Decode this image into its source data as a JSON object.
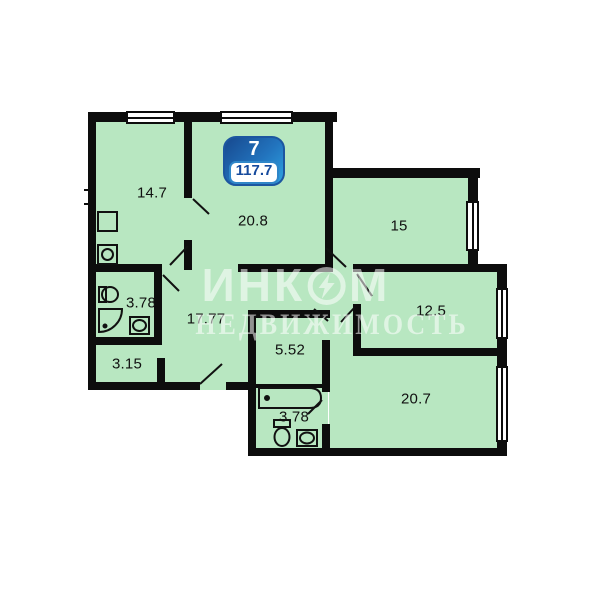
{
  "unit_badge": {
    "rooms_count": "7",
    "total_area": "117.7"
  },
  "rooms": [
    {
      "name": "kitchen",
      "area": "14.7"
    },
    {
      "name": "living-room",
      "area": "20.8"
    },
    {
      "name": "bedroom-top-right",
      "area": "15"
    },
    {
      "name": "bedroom-right",
      "area": "12.5"
    },
    {
      "name": "bedroom-bottom-right",
      "area": "20.7"
    },
    {
      "name": "hallway",
      "area": "17.77"
    },
    {
      "name": "bathroom-left",
      "area": "3.78"
    },
    {
      "name": "storage",
      "area": "3.15"
    },
    {
      "name": "inner-hall",
      "area": "5.52"
    },
    {
      "name": "bathroom-bottom",
      "area": "3.78"
    }
  ],
  "watermark": {
    "brand_left": "ИНК",
    "brand_right": "М",
    "line2": "НЕДВИЖИМОСТЬ"
  },
  "colors": {
    "room_fill": "#b8e7c1",
    "wall": "#0d0d0d",
    "badge_dark_blue": "#1c56a0",
    "badge_light_blue": "#2ea3e2",
    "badge_text_blue": "#164a9d"
  }
}
